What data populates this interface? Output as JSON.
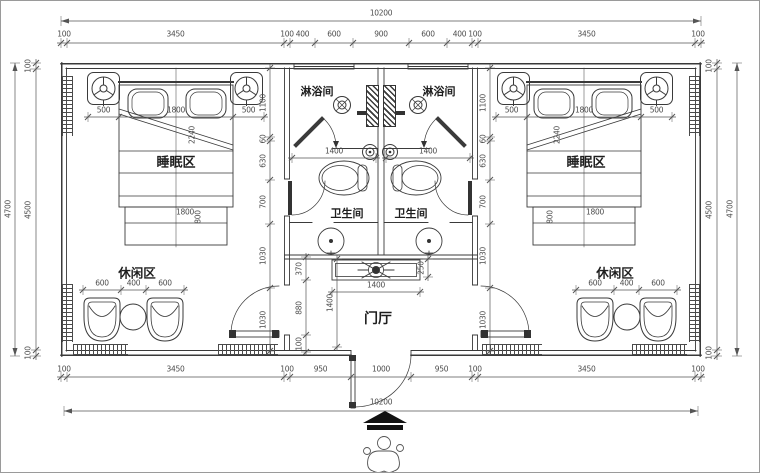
{
  "labels": {
    "sleep_area": "睡眠区",
    "leisure_area": "休闲区",
    "shower_room": "淋浴间",
    "toilet_room": "卫生间",
    "entry_hall": "门厅"
  },
  "dims": {
    "overall_width": "10200",
    "overall_height": "4700",
    "top_chain": [
      "100",
      "3450",
      "100",
      "400",
      "600",
      "900",
      "600",
      "400",
      "100",
      "3450",
      "100"
    ],
    "bottom_chain": [
      "100",
      "3450",
      "100",
      "950",
      "1000",
      "950",
      "100",
      "3450",
      "100"
    ],
    "side_chain": [
      "100",
      "4500",
      "100"
    ],
    "inner_wall_chain": [
      "1100",
      "60",
      "630",
      "700",
      "1030",
      "1030"
    ],
    "bed_head": [
      "500",
      "1800",
      "500"
    ],
    "bed_foot_w": "1800",
    "bed_foot_d": "800",
    "bed_diag": "2240",
    "leisure_chain": [
      "600",
      "400",
      "600"
    ],
    "bath_width": [
      "1400"
    ],
    "hall_cabinet_w": [
      "1400"
    ],
    "hall_depth": [
      "1400"
    ],
    "hall_gap": [
      "250"
    ],
    "hall_side_chain": [
      "370",
      "880",
      "100"
    ]
  },
  "icons": {
    "ceiling_speaker": "rounded-square-3-spoke-circle",
    "floor_drain": "crossed-double-circle",
    "paper_holder": "spiral-circle",
    "ceiling_fan": "x-cross-with-hub",
    "entry_arrow": "solid-up-arrow",
    "person_figure": "cartoon-figure-at-entrance"
  },
  "colors": {
    "line": "#3a3a3a",
    "dim": "#555555",
    "text": "#1e1e1e",
    "bg": "#ffffff"
  }
}
